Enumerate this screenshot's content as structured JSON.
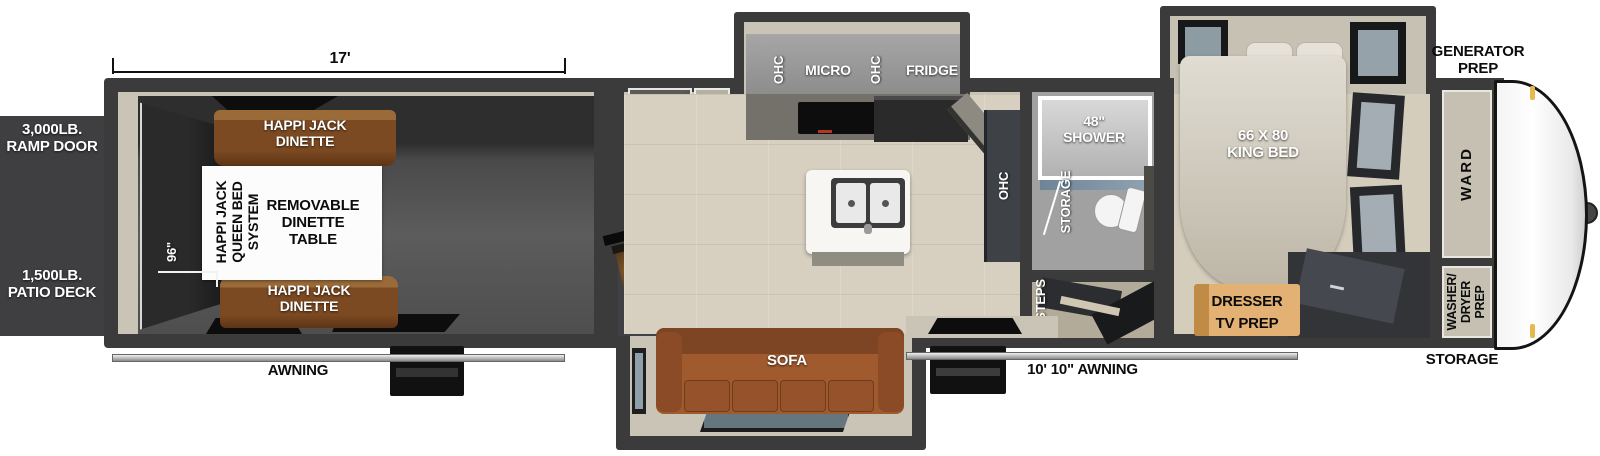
{
  "title": "Toy hauler fifth wheel floorplan",
  "dimensions": {
    "garage_length": "17'",
    "garage_width": "96\""
  },
  "exterior": {
    "ramp_door": "3,000LB.\nRAMP DOOR",
    "patio_deck": "1,500LB.\nPATIO DECK",
    "awning_rear": "AWNING",
    "awning_main": "10' 10\" AWNING",
    "generator_prep": "GENERATOR\nPREP",
    "storage_front": "STORAGE"
  },
  "garage": {
    "dinette_top": "HAPPI JACK\nDINETTE",
    "dinette_bottom": "HAPPI JACK\nDINETTE",
    "queen_bed_system": "HAPPI JACK\nQUEEN BED\nSYSTEM",
    "removable_table": "REMOVABLE\nDINETTE\nTABLE"
  },
  "kitchen": {
    "ohc_left": "OHC",
    "micro": "MICRO",
    "ohc_right": "OHC",
    "fridge": "FRIDGE",
    "pantry": "20 CU FT\nPANTRY",
    "ohc_wall": "OHC"
  },
  "living": {
    "tv": "55\" TV\nW/ FIREPLACE",
    "sofa": "SOFA"
  },
  "bath": {
    "shower": "48\"\nSHOWER",
    "storage": "STORAGE",
    "steps": "STEPS"
  },
  "bedroom": {
    "king_bed": "66 X 80\nKING BED",
    "ward": "WARD",
    "washer_dryer": "WASHER/\nDRYER\nPREP",
    "dresser": "DRESSER",
    "tv_prep": "TV PREP"
  },
  "colors": {
    "outer_wall": "#3b3b3b",
    "interior_wall": "#c9c4b6",
    "garage_floor": "#565656",
    "living_floor": "#d7d0c1",
    "dinette_brown": "#7c4a22",
    "sofa_brown": "#a05a2e",
    "dresser_wood": "#e2b173",
    "tv_glow": "#e89a35",
    "front_cap": "#ffffff",
    "marker_light": "#e6b94d",
    "shower_glass": "#7d94a6"
  }
}
